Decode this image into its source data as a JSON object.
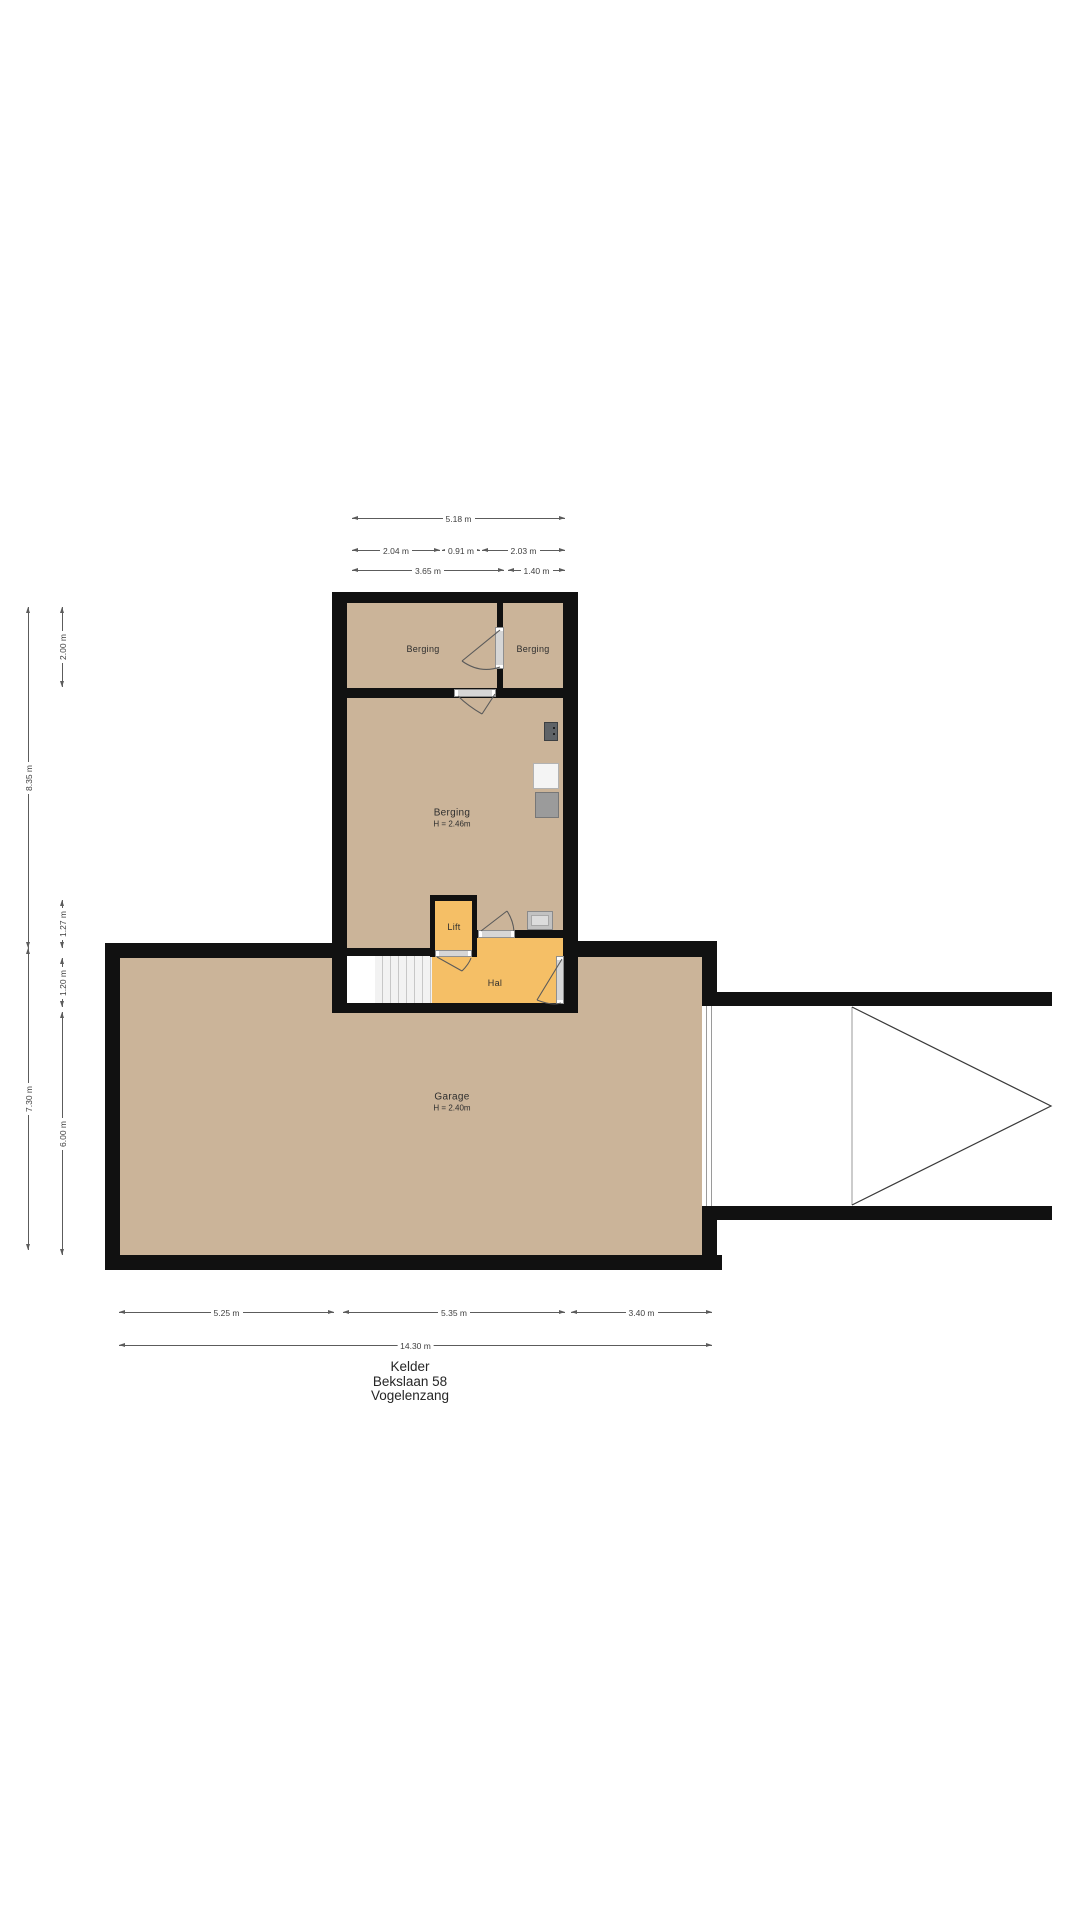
{
  "plan_title": {
    "floor": "Kelder",
    "street": "Bekslaan 58",
    "city": "Vogelenzang"
  },
  "rooms": {
    "berging_top_left": {
      "name": "Berging"
    },
    "berging_top_right": {
      "name": "Berging"
    },
    "berging_main": {
      "name": "Berging",
      "height": "H = 2.46m"
    },
    "lift": {
      "name": "Lift"
    },
    "hal": {
      "name": "Hal"
    },
    "garage": {
      "name": "Garage",
      "height": "H = 2.40m"
    }
  },
  "dimensions": {
    "top": [
      {
        "label": "5.18 m"
      },
      {
        "label": "2.04 m"
      },
      {
        "label": "0.91 m"
      },
      {
        "label": "2.03 m"
      },
      {
        "label": "3.65 m"
      },
      {
        "label": "1.40 m"
      }
    ],
    "left": [
      {
        "label": "8.35 m"
      },
      {
        "label": "7.30 m"
      },
      {
        "label": "2.00 m"
      },
      {
        "label": "1.27 m"
      },
      {
        "label": "1.20 m"
      },
      {
        "label": "6.00 m"
      }
    ],
    "bottom": [
      {
        "label": "5.25 m"
      },
      {
        "label": "5.35 m"
      },
      {
        "label": "3.40 m"
      },
      {
        "label": "14.30 m"
      }
    ]
  },
  "colors": {
    "wall": "#111111",
    "floor": "#cbb499",
    "hall": "#f5bf66",
    "stairs": "#ededed",
    "dimtext": "#3f3f3f"
  }
}
